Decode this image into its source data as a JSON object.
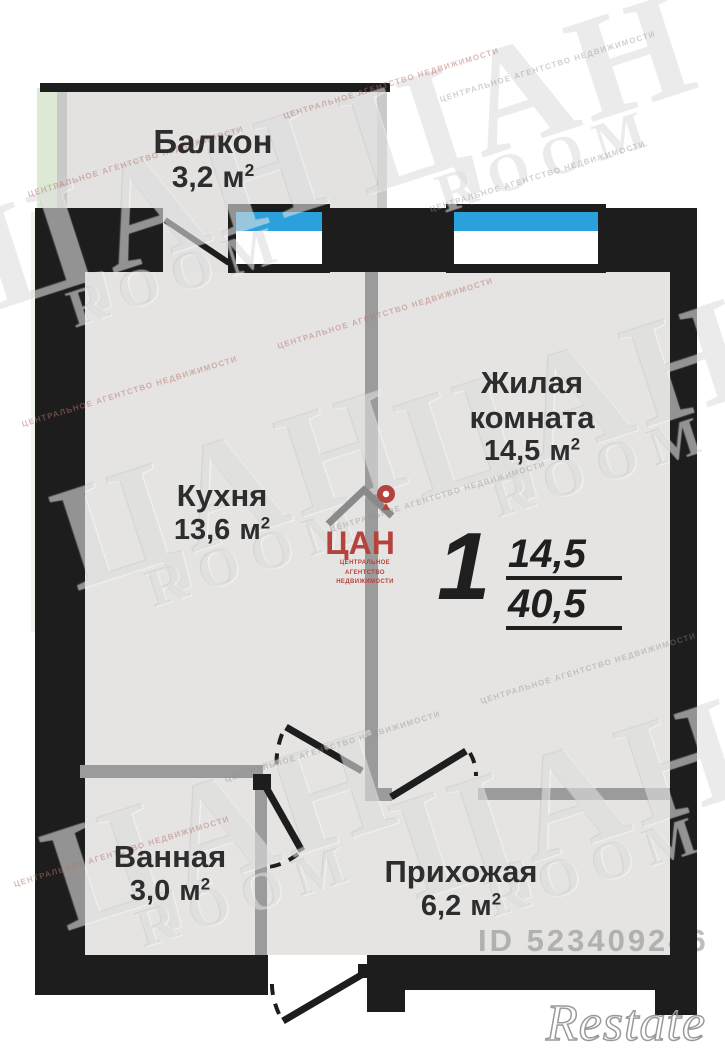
{
  "rooms": {
    "balcony": {
      "name": "Балкон",
      "area": "3,2",
      "unit": "м",
      "sup": "2"
    },
    "living_room": {
      "name": "Жилая комната",
      "area": "14,5",
      "unit": "м",
      "sup": "2"
    },
    "kitchen": {
      "name": "Кухня",
      "area": "13,6",
      "unit": "м",
      "sup": "2"
    },
    "bathroom": {
      "name": "Ванная",
      "area": "3,0",
      "unit": "м",
      "sup": "2"
    },
    "hallway": {
      "name": "Прихожая",
      "area": "6,2",
      "unit": "м",
      "sup": "2"
    }
  },
  "summary": {
    "rooms_count": "1",
    "living_area": "14,5",
    "total_area": "40,5"
  },
  "agency_logo": {
    "brand": "ЦАН",
    "tagline_line1": "ЦЕНТРАЛЬНОЕ АГЕНТСТВО",
    "tagline_line2": "НЕДВИЖИМОСТИ"
  },
  "watermarks": {
    "brand_big": "ЦАН",
    "brand_room": "ROOM",
    "tiled_line": "ЦЕНТРАЛЬНОЕ АГЕНТСТВО НЕДВИЖИМОСТИ",
    "listing_id": "ID 523409246",
    "restate": "Restate"
  },
  "colors": {
    "wall_black": "#1d1d1d",
    "wall_gray": "#9b9b9b",
    "floor": "#e5e4e2",
    "balcony_floor": "#e3e2e0",
    "window_blue": "#2aa0dc",
    "green_strip": "#dcead5",
    "logo_red": "#b5433d"
  }
}
